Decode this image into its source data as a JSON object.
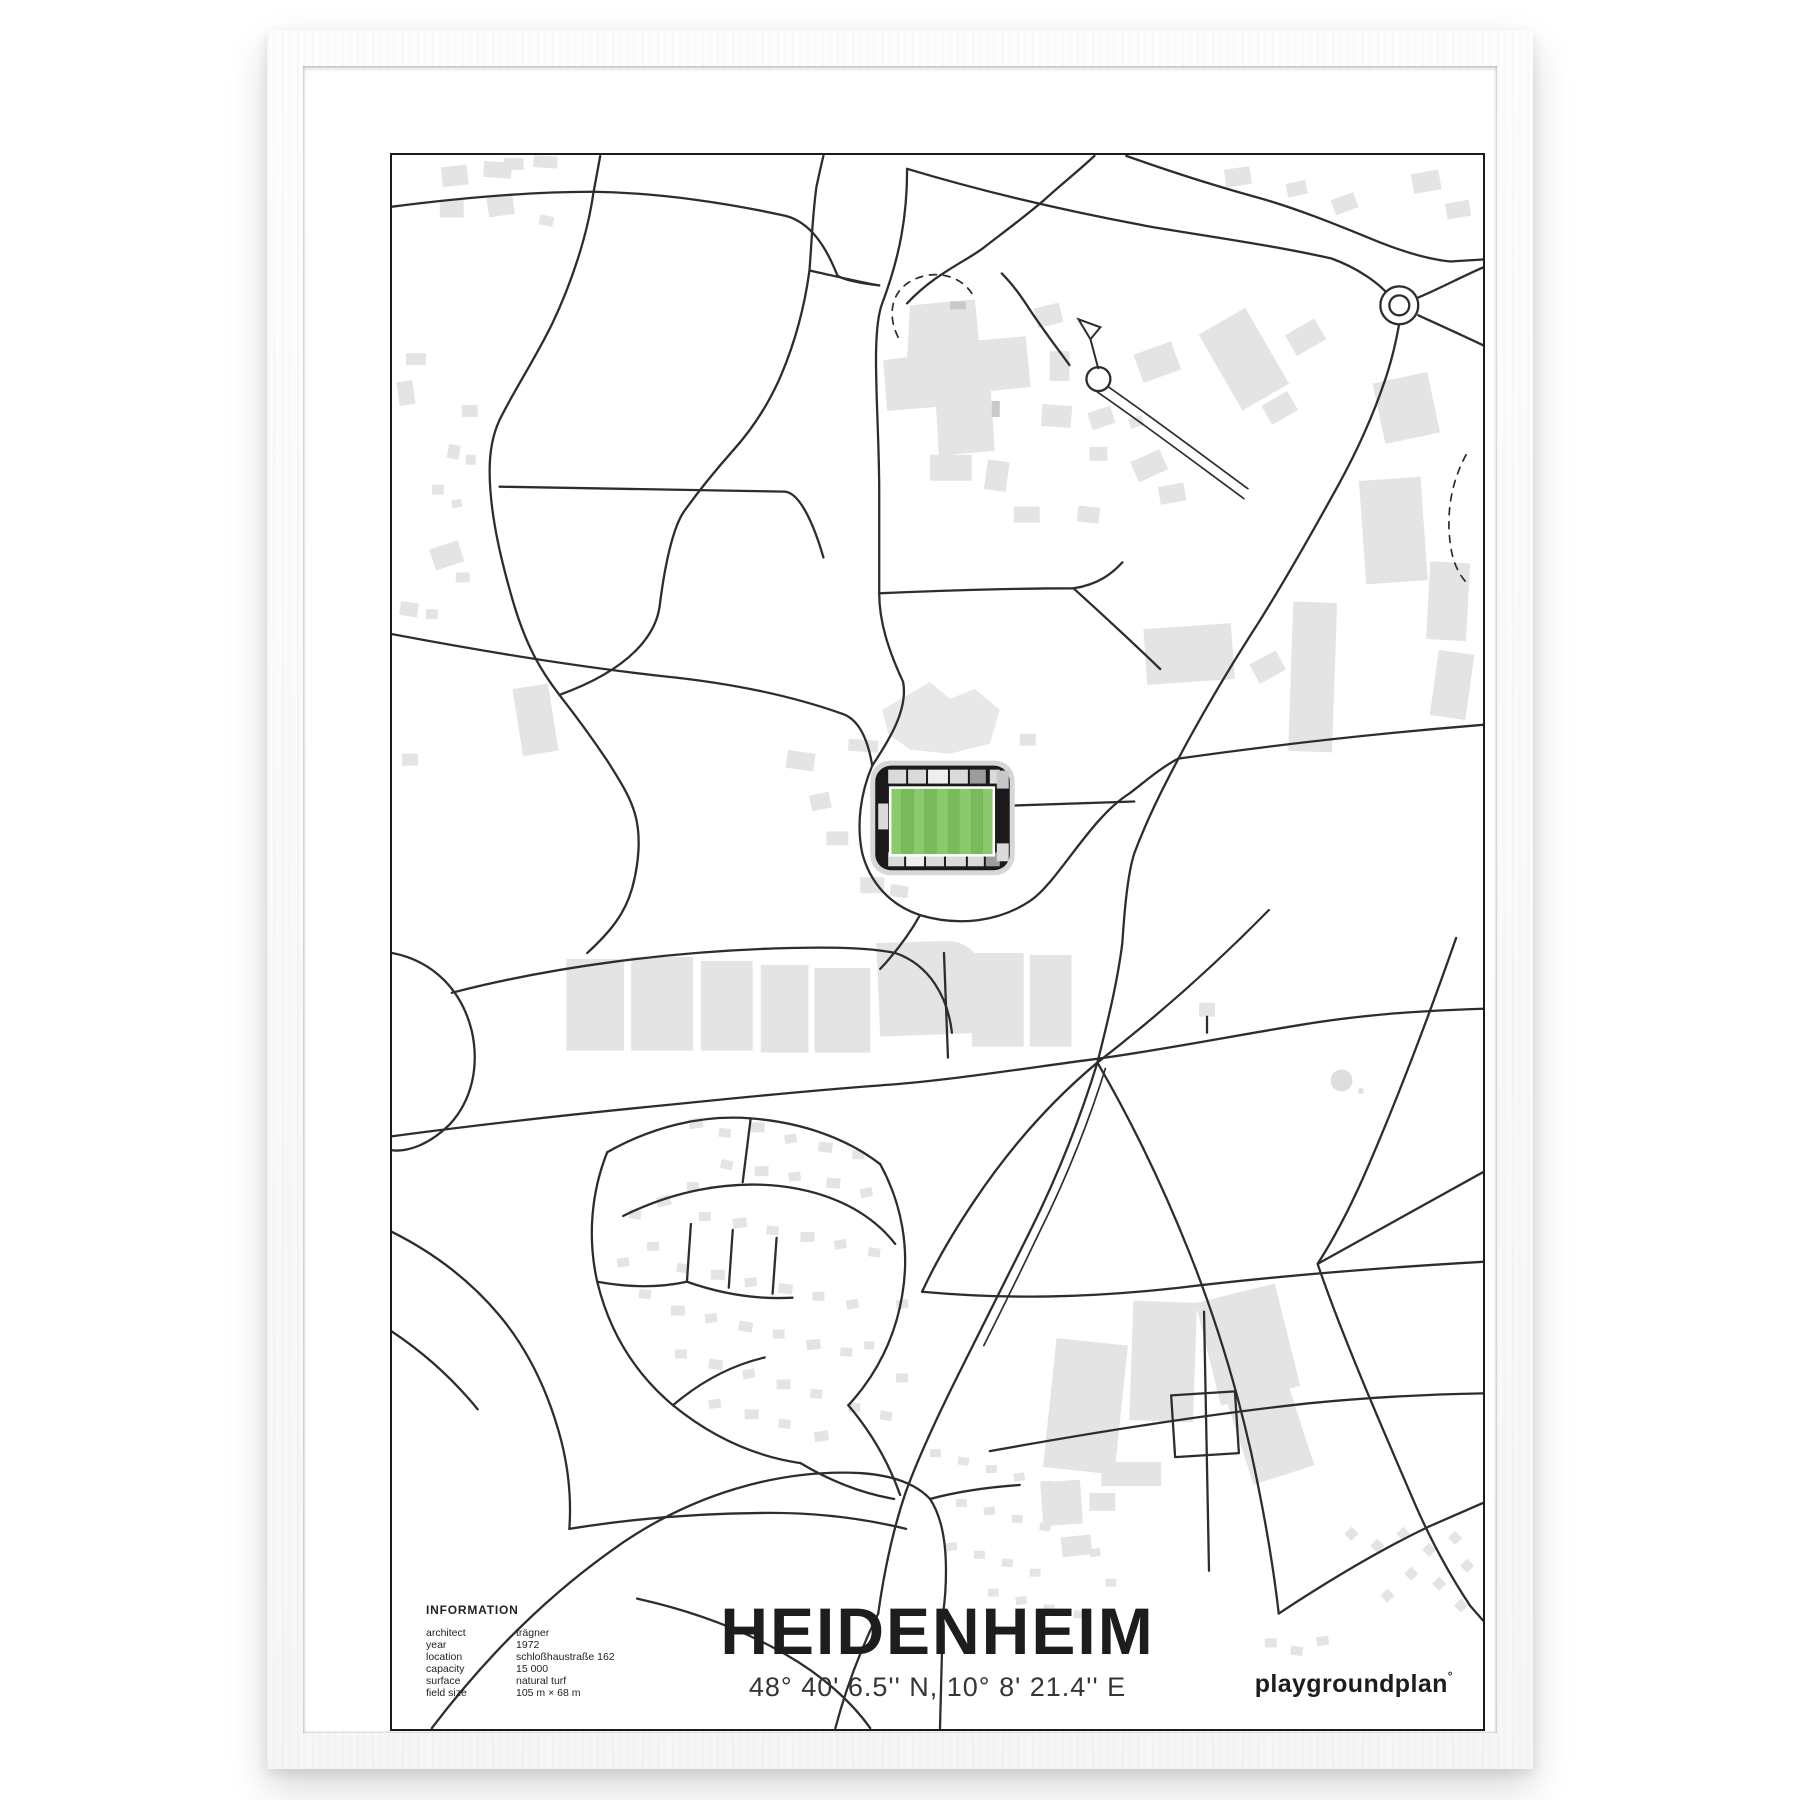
{
  "poster": {
    "title": "HEIDENHEIM",
    "coordinates": "48° 40' 6.5'' N, 10° 8' 21.4'' E",
    "brand": "playgroundplan",
    "brand_mark": "°",
    "info": {
      "heading": "INFORMATION",
      "rows": [
        {
          "label": "architect",
          "value": "trägner"
        },
        {
          "label": "year",
          "value": "1972"
        },
        {
          "label": "location",
          "value": "schloßhaustraße 162"
        },
        {
          "label": "capacity",
          "value": "15 000"
        },
        {
          "label": "surface",
          "value": "natural turf"
        },
        {
          "label": "field size",
          "value": "105 m × 68 m"
        }
      ]
    }
  },
  "map": {
    "style": "minimal black-and-white street map with highlighted stadium",
    "colors": {
      "road": "#2d2d2d",
      "building": "#e4e4e4",
      "building_dark": "#c9c9c9",
      "stadium_shell": "#1a1a1a",
      "stand_light": "#dadada",
      "stand_gray": "#9c9c9c",
      "pitch_stripe_light": "#8ac96d",
      "pitch_stripe_dark": "#79bb5a",
      "pitch_border": "#ffffff"
    },
    "features": {
      "stadium": "Voith-Arena footprint with striped green pitch at map center",
      "roundabouts": 2,
      "dashed_paths": 2
    }
  }
}
